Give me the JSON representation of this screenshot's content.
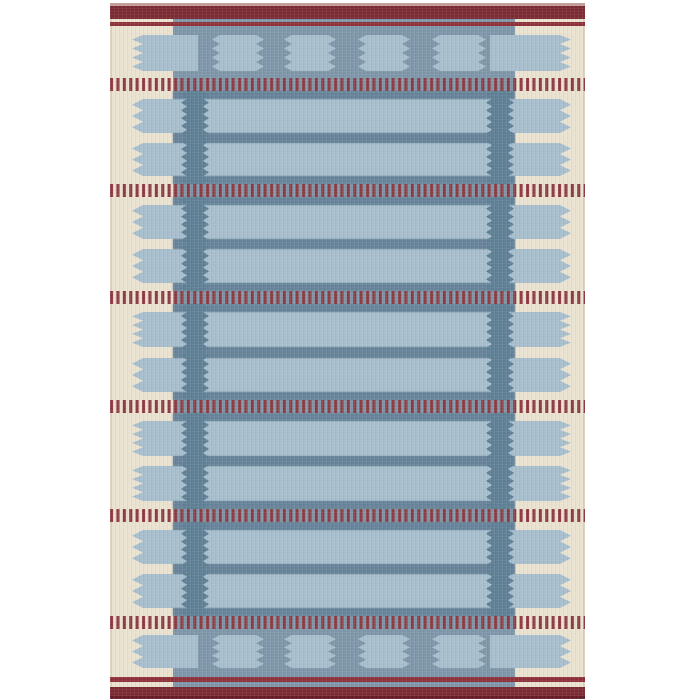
{
  "scene": {
    "type": "product-photo",
    "subject": "Flat-woven kilim rug with Scandinavian geometric pattern in blue, cream and dark red",
    "background_color": "#ffffff"
  },
  "palette": {
    "cream": "#eae2d0",
    "cream_shade": "#ddd3bf",
    "field_blue": "#7d97a9",
    "light_blue": "#a7becd",
    "dark_blue": "#5e7f95",
    "stripe_blue": "#668399",
    "band_red": "#7b2a33",
    "band_red_dark": "#671d27",
    "edge_pink": "#c29d99",
    "line_red": "#8e3039",
    "dash_red": "#8c3a43"
  },
  "canvas": {
    "width": 700,
    "height": 700
  },
  "rug": {
    "x0": 110,
    "x1": 585,
    "top_edge": {
      "y0": 3,
      "y1": 6
    },
    "top_band": {
      "y0": 6,
      "y1": 19
    },
    "top_line": {
      "y0": 22,
      "y1": 26
    },
    "bottom_line": {
      "y0": 677,
      "y1": 682
    },
    "bottom_band": {
      "y0": 687,
      "y1": 696
    },
    "bottom_edge": {
      "y0": 696,
      "y1": 699
    },
    "field": {
      "x0": 173,
      "x1": 515,
      "y0": 19,
      "y1": 687
    }
  },
  "columns": {
    "list": [
      {
        "base0": 187,
        "base1": 203,
        "tip0": 181,
        "tip1": 209
      },
      {
        "base0": 492,
        "base1": 508,
        "tip0": 486,
        "tip1": 514
      }
    ],
    "period": 8
  },
  "tabs": {
    "left": {
      "tip": 132,
      "base": 143,
      "body": 198
    },
    "right": {
      "tip": 571,
      "base": 560,
      "body": 490
    },
    "period": 10
  },
  "rows": [
    {
      "y0": 35,
      "y1": 71,
      "type": "blocks"
    },
    {
      "y0": 99,
      "y1": 133,
      "type": "band"
    },
    {
      "y0": 143,
      "y1": 176,
      "type": "band"
    },
    {
      "y0": 205,
      "y1": 239,
      "type": "band"
    },
    {
      "y0": 249,
      "y1": 283,
      "type": "band"
    },
    {
      "y0": 312,
      "y1": 347,
      "type": "band"
    },
    {
      "y0": 358,
      "y1": 392,
      "type": "band"
    },
    {
      "y0": 421,
      "y1": 456,
      "type": "band"
    },
    {
      "y0": 466,
      "y1": 501,
      "type": "band"
    },
    {
      "y0": 530,
      "y1": 564,
      "type": "band"
    },
    {
      "y0": 574,
      "y1": 608,
      "type": "band"
    },
    {
      "y0": 635,
      "y1": 668,
      "type": "blocks"
    }
  ],
  "blocks": {
    "x_ranges": [
      [
        212,
        264
      ],
      [
        284,
        336
      ],
      [
        358,
        410
      ],
      [
        432,
        486
      ]
    ],
    "tooth_depth": 8,
    "period": 9
  },
  "stripes": [
    {
      "y0": 91,
      "y1": 99
    },
    {
      "y0": 133,
      "y1": 143
    },
    {
      "y0": 176,
      "y1": 184
    },
    {
      "y0": 197,
      "y1": 205
    },
    {
      "y0": 239,
      "y1": 249
    },
    {
      "y0": 283,
      "y1": 291
    },
    {
      "y0": 304,
      "y1": 312
    },
    {
      "y0": 347,
      "y1": 358
    },
    {
      "y0": 392,
      "y1": 400
    },
    {
      "y0": 413,
      "y1": 421
    },
    {
      "y0": 456,
      "y1": 466
    },
    {
      "y0": 501,
      "y1": 509
    },
    {
      "y0": 522,
      "y1": 530
    },
    {
      "y0": 564,
      "y1": 574
    },
    {
      "y0": 608,
      "y1": 616
    }
  ],
  "dash_bands": [
    {
      "y0": 78,
      "y1": 91
    },
    {
      "y0": 184,
      "y1": 197
    },
    {
      "y0": 291,
      "y1": 304
    },
    {
      "y0": 400,
      "y1": 413
    },
    {
      "y0": 509,
      "y1": 522
    },
    {
      "y0": 616,
      "y1": 629
    }
  ],
  "dash": {
    "period": 6.4,
    "width": 3.1
  }
}
